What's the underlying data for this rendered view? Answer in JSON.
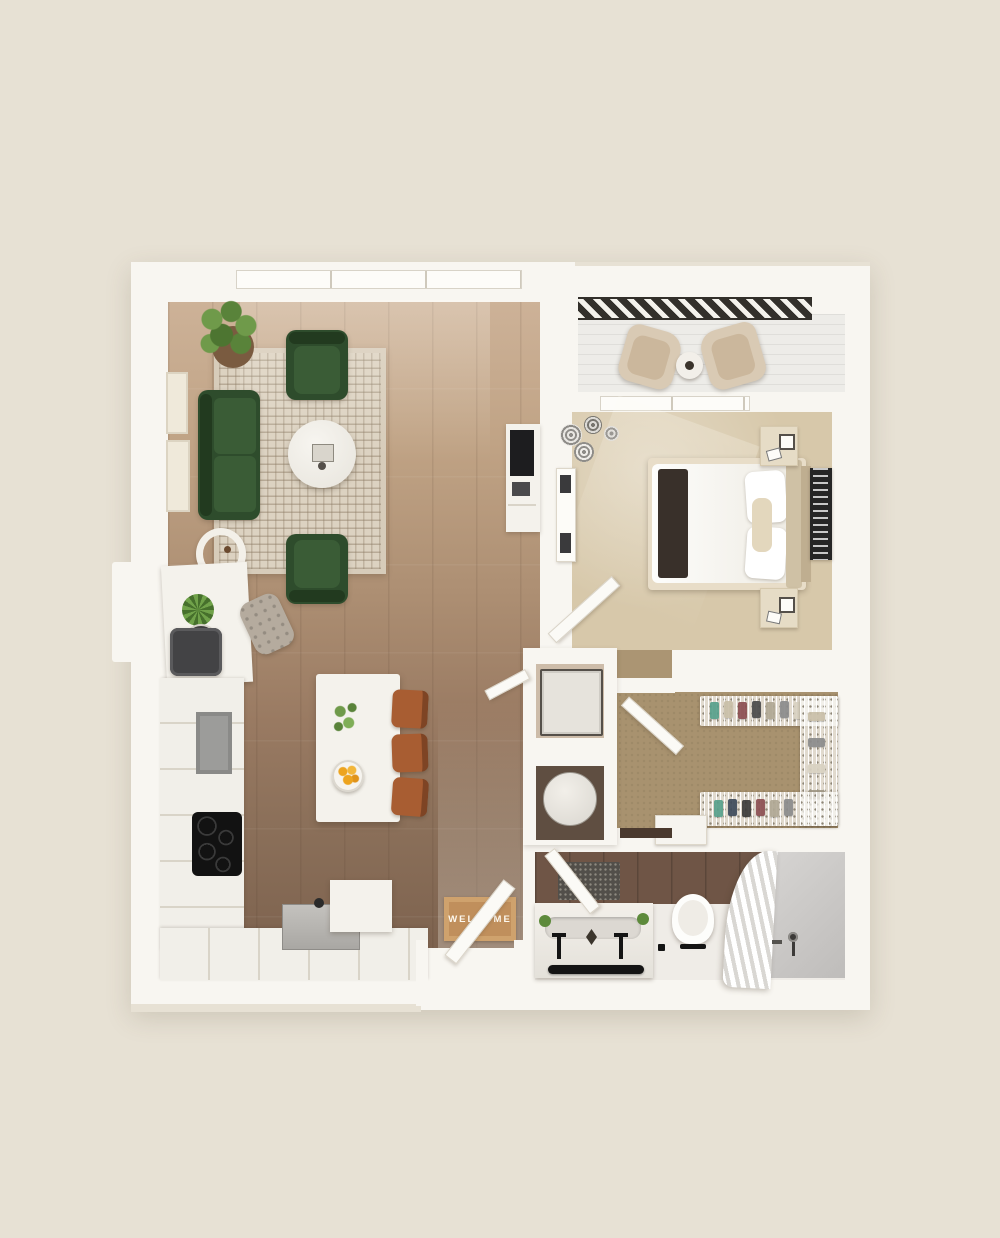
{
  "welcome_mat": {
    "text": "WELCOME"
  },
  "colors": {
    "bg": "#e7e1d4",
    "wall": "#f8f6f1",
    "wood-light": "#cdb298",
    "wood-dark": "#7e634f",
    "rug": "#dcd2c1",
    "rug-line": "#8b7a63",
    "sofa-green": "#2e4c2c",
    "sofa-green-light": "#3a5c36",
    "sofa-green-dark": "#223a1f",
    "carpet-bedroom": "#d7c8aa",
    "carpet-closet": "#a8926f",
    "carpet-hall": "#ab9573",
    "balcony-deck": "#edece8",
    "railing-dark": "#33302b",
    "stool-brown": "#a85d32",
    "stool-brown-dark": "#7e4424",
    "mat-tan": "#c08f5c",
    "mat-border": "#cfa26d",
    "mat-text-color": "#fdf8ee",
    "bath-tile": "#6f5546",
    "shower-gray": "#c6c4c2",
    "appliance-black": "#141414",
    "appliance-gray": "#9c9c9a",
    "leaf-green": "#5d8a3b",
    "fruit-orange": "#eda41f",
    "headboard-tan": "#cfc1a5",
    "runner-brown": "#39302a",
    "accent-teal": "#57a08b",
    "accent-maroon": "#8c4f52",
    "accent-navy": "#3e4a5a"
  },
  "rooms": [
    {
      "name": "living-room",
      "items": [
        "sofa",
        "armchair-top",
        "armchair-bottom",
        "coffee-table",
        "area-rug",
        "potted-plant",
        "side-table",
        "tv-console",
        "wall-frames"
      ]
    },
    {
      "name": "kitchen-dining",
      "items": [
        "kitchen-island",
        "bar-stools",
        "cooktop",
        "refrigerator",
        "wall-oven",
        "sink",
        "dishwasher",
        "fruit-bowl",
        "flower-sprig"
      ]
    },
    {
      "name": "balcony",
      "items": [
        "lounge-chair-left",
        "lounge-chair-right",
        "side-table",
        "railing"
      ]
    },
    {
      "name": "bedroom",
      "items": [
        "bed",
        "runner-blanket",
        "pillows",
        "headboard",
        "nightstand-top",
        "nightstand-bottom",
        "wall-art",
        "dresser",
        "decor-vases"
      ]
    },
    {
      "name": "walk-in-closet",
      "items": [
        "wire-shelving",
        "clothes",
        "shoes",
        "mini-dresser"
      ]
    },
    {
      "name": "bathroom",
      "items": [
        "vanity",
        "double-faucet",
        "towel-bar",
        "bath-mat",
        "toilet",
        "shower",
        "shower-curtain",
        "shower-fixture"
      ]
    },
    {
      "name": "entry",
      "items": [
        "welcome-mat",
        "entry-door",
        "console-desk",
        "desk-chair",
        "starburst-plant"
      ]
    },
    {
      "name": "utility",
      "items": [
        "washer-dryer",
        "water-heater"
      ]
    }
  ]
}
